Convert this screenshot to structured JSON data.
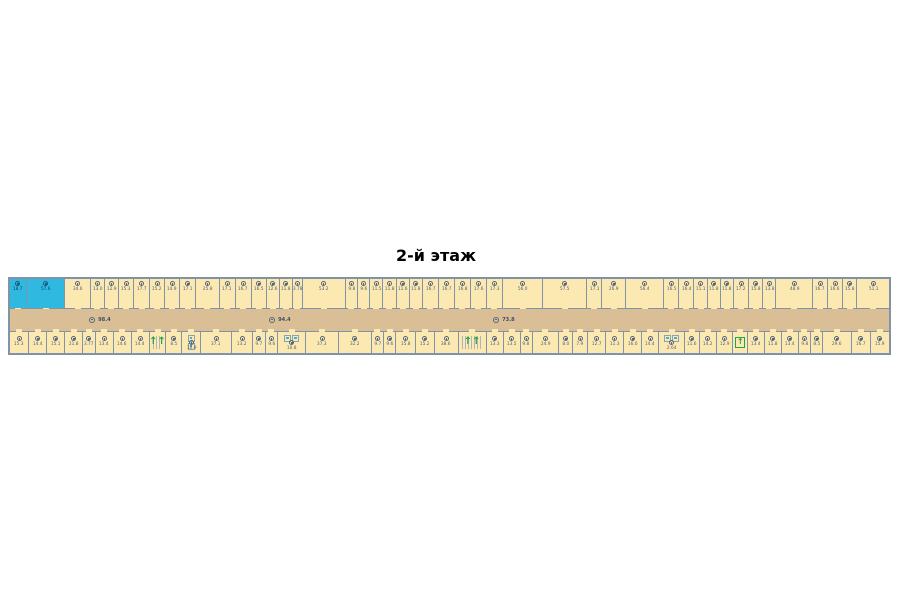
{
  "title": "2-й этаж",
  "colors": {
    "wall": "#8093A9",
    "room_fill": "#FCE9B2",
    "corridor_fill": "#DABF96",
    "highlight_room": "#2FB9E1",
    "stairs_green": "#22A14B",
    "label_text": "#4e5e73"
  },
  "plan": {
    "corridor_labels": [
      {
        "area": "98.4",
        "x_pct": 9.0
      },
      {
        "area": "94.4",
        "x_pct": 29.5
      },
      {
        "area": "73.8",
        "x_pct": 55.0
      }
    ],
    "top_rooms": [
      {
        "area": "18.7",
        "w": 17,
        "type": "highlight"
      },
      {
        "area": "57.6",
        "w": 40,
        "type": "highlight"
      },
      {
        "area": "34.6",
        "w": 26
      },
      {
        "area": "13.0",
        "w": 14
      },
      {
        "area": "12.9",
        "w": 14
      },
      {
        "area": "15.3",
        "w": 15
      },
      {
        "area": "17.7",
        "w": 16
      },
      {
        "area": "15.2",
        "w": 15
      },
      {
        "area": "14.9",
        "w": 15
      },
      {
        "area": "17.1",
        "w": 16
      },
      {
        "area": "25.8",
        "w": 24
      },
      {
        "area": "17.1",
        "w": 16
      },
      {
        "area": "16.7",
        "w": 16
      },
      {
        "area": "16.5",
        "w": 15
      },
      {
        "area": "12.6",
        "w": 13
      },
      {
        "area": "11.8",
        "w": 13
      },
      {
        "area": "3.78",
        "w": 9
      },
      {
        "area": "53.2",
        "w": 45
      },
      {
        "area": "9.8",
        "w": 12
      },
      {
        "area": "9.6",
        "w": 12
      },
      {
        "area": "11.5",
        "w": 13
      },
      {
        "area": "11.8",
        "w": 13
      },
      {
        "area": "11.6",
        "w": 13
      },
      {
        "area": "11.8",
        "w": 13
      },
      {
        "area": "16.7",
        "w": 16
      },
      {
        "area": "16.7",
        "w": 16
      },
      {
        "area": "16.8",
        "w": 16
      },
      {
        "area": "17.6",
        "w": 16
      },
      {
        "area": "17.3",
        "w": 16
      },
      {
        "area": "56.0",
        "w": 42
      },
      {
        "area": "57.5",
        "w": 46
      },
      {
        "area": "17.1",
        "w": 15
      },
      {
        "area": "26.9",
        "w": 24
      },
      {
        "area": "56.4",
        "w": 40
      },
      {
        "area": "16.5",
        "w": 15
      },
      {
        "area": "16.4",
        "w": 15
      },
      {
        "area": "11.1",
        "w": 13
      },
      {
        "area": "11.8",
        "w": 13
      },
      {
        "area": "11.8",
        "w": 13
      },
      {
        "area": "17.2",
        "w": 15
      },
      {
        "area": "15.8",
        "w": 14
      },
      {
        "area": "13.8",
        "w": 13
      },
      {
        "area": "48.9",
        "w": 38
      },
      {
        "area": "16.7",
        "w": 15
      },
      {
        "area": "16.6",
        "w": 15
      },
      {
        "area": "15.8",
        "w": 14
      },
      {
        "area": "51.1",
        "w": 34
      }
    ],
    "bottom_rooms": [
      {
        "area": "15.3",
        "w": 16
      },
      {
        "area": "14.4",
        "w": 15
      },
      {
        "area": "15.1",
        "w": 15
      },
      {
        "area": "21.8",
        "w": 15
      },
      {
        "area": "3.77",
        "w": 10
      },
      {
        "area": "13.4",
        "w": 15
      },
      {
        "area": "14.6",
        "w": 15
      },
      {
        "area": "14.4",
        "w": 15
      },
      {
        "area": "",
        "w": 14,
        "type": "stairs"
      },
      {
        "area": "8.5",
        "w": 13
      },
      {
        "area": "10.9",
        "w": 16,
        "type": "wc"
      },
      {
        "area": "37.1",
        "w": 26
      },
      {
        "area": "13.2",
        "w": 18
      },
      {
        "area": "9.7",
        "w": 10
      },
      {
        "area": "9.6",
        "w": 10
      },
      {
        "area": "10.8",
        "w": 24,
        "type": "wc"
      },
      {
        "area": "37.3",
        "w": 28
      },
      {
        "area": "32.2",
        "w": 28
      },
      {
        "area": "9.7",
        "w": 10
      },
      {
        "area": "9.6",
        "w": 10
      },
      {
        "area": "15.8",
        "w": 16
      },
      {
        "area": "15.2",
        "w": 16
      },
      {
        "area": "38.6",
        "w": 20
      },
      {
        "area": "",
        "w": 24,
        "type": "stairs"
      },
      {
        "area": "13.3",
        "w": 14
      },
      {
        "area": "13.5",
        "w": 14
      },
      {
        "area": "9.8",
        "w": 10
      },
      {
        "area": "24.9",
        "w": 22
      },
      {
        "area": "8.0",
        "w": 12
      },
      {
        "area": "7.9",
        "w": 12
      },
      {
        "area": "12.7",
        "w": 15
      },
      {
        "area": "11.3",
        "w": 15
      },
      {
        "area": "16.0",
        "w": 15
      },
      {
        "area": "14.4",
        "w": 14
      },
      {
        "area": "2.64",
        "w": 22,
        "type": "wc"
      },
      {
        "area": "11.6",
        "w": 12
      },
      {
        "area": "14.2",
        "w": 14
      },
      {
        "area": "12.9",
        "w": 14
      },
      {
        "area": "",
        "w": 12,
        "type": "lift"
      },
      {
        "area": "13.4",
        "w": 14
      },
      {
        "area": "11.8",
        "w": 14
      },
      {
        "area": "13.4",
        "w": 14
      },
      {
        "area": "9.8",
        "w": 10
      },
      {
        "area": "8.5",
        "w": 10
      },
      {
        "area": "29.6",
        "w": 24
      },
      {
        "area": "16.7",
        "w": 16
      },
      {
        "area": "15.9",
        "w": 16
      }
    ],
    "stairs_symbol": "↑↑",
    "lift_symbol": "↑"
  }
}
